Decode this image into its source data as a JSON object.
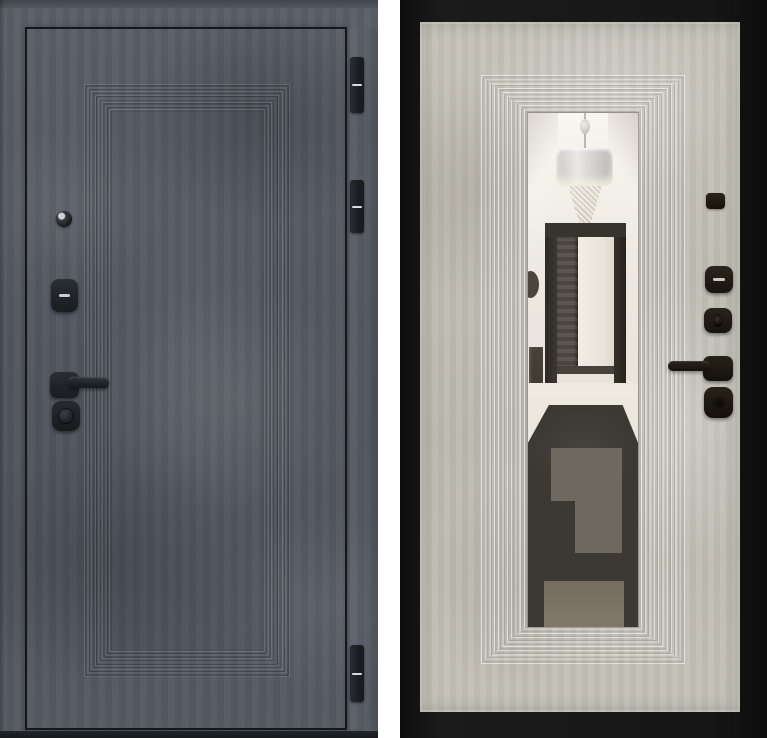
{
  "image": {
    "type": "product-photo",
    "subject": "steel entry door shown from both sides",
    "background_color": "#ffffff"
  },
  "exterior_view": {
    "label": "Exterior side: graphite concrete finish with stepped panel molding",
    "finish_color": "#565b64",
    "trim_line_color": "#15171a",
    "molding": {
      "style": "stepped concentric rectangles",
      "line_count": 8
    },
    "hardware": {
      "peephole": "peephole viewer",
      "lock_cover": "upper lock cover with slot",
      "handle": "lever handle on square rose",
      "cylinder": "round lock cylinder knob"
    },
    "hinges": {
      "count": 3,
      "color": "#1a1c1f",
      "pin_highlight": "#d9dadc"
    }
  },
  "interior_view": {
    "label": "Interior side: light concrete panel with full-length mirror insert",
    "frame_color": "#141414",
    "panel_color": "#c2bfb6",
    "molding": {
      "style": "stepped concentric rectangles",
      "line_count": 9
    },
    "mirror": {
      "label": "mirror reflection of hallway",
      "reflection_elements": [
        "drum chandelier with crystals",
        "open dark doorway",
        "white walls",
        "dark patterned rug on light floor"
      ],
      "rug_colors": [
        "#3c3834",
        "#6f6861",
        "#7b7265"
      ]
    },
    "hardware": {
      "night_latch": "small latch plate",
      "thumb_turn": "thumb-turn cover with slot",
      "cylinder": "keyed cylinder",
      "handle": "lever handle on square rose",
      "guard": "cylinder guard plate"
    }
  }
}
